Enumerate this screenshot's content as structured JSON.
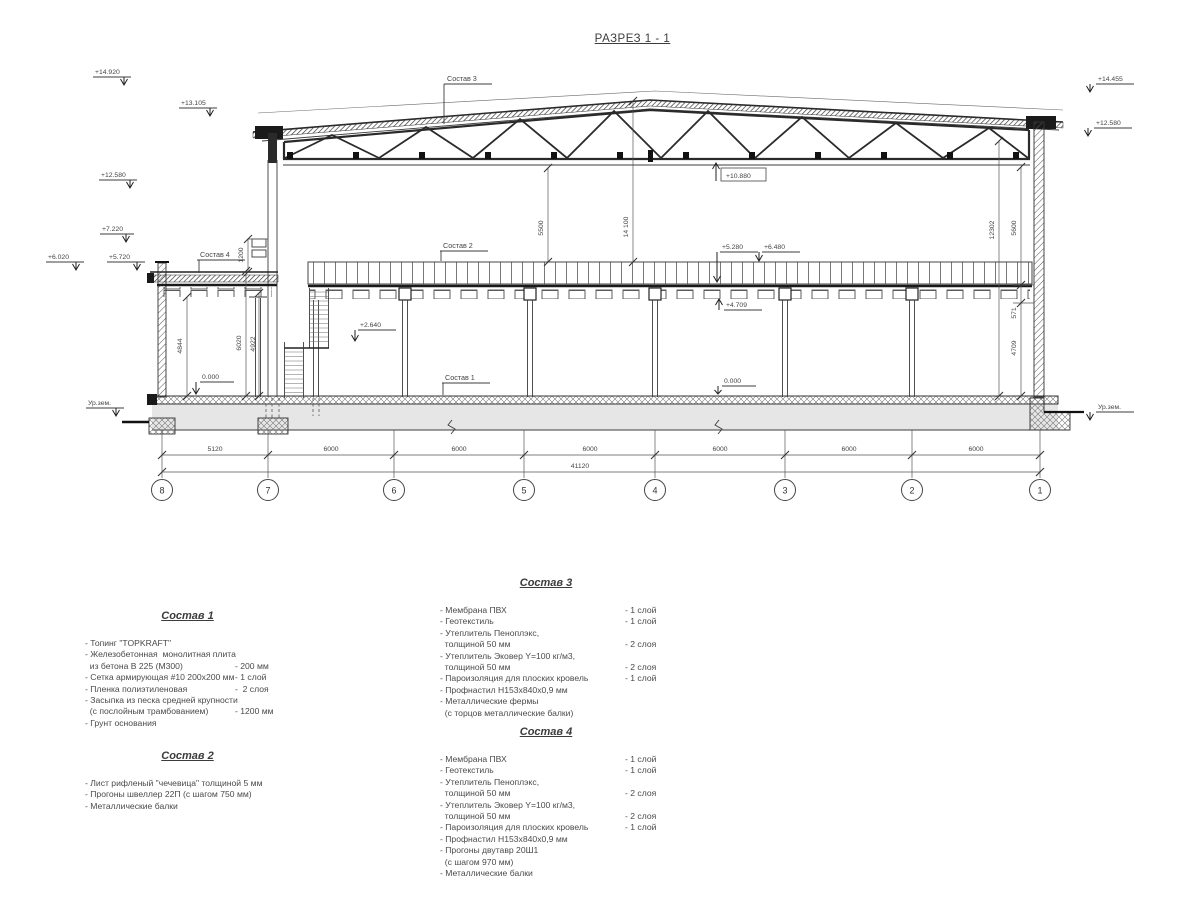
{
  "title": "РАЗРЕЗ 1 - 1",
  "colors": {
    "line": "#3c3c3c",
    "ground_fill": "#e6e6e6",
    "dark": "#1a1a1a"
  },
  "axes": [
    "8",
    "7",
    "6",
    "5",
    "4",
    "3",
    "2",
    "1"
  ],
  "hdims": {
    "spans": [
      "5120",
      "6000",
      "6000",
      "6000",
      "6000",
      "6000",
      "6000"
    ],
    "total": "41120"
  },
  "vdims": {
    "v5500": "5500",
    "v14100": "14 100",
    "v1200": "1200",
    "v4844": "4844",
    "v6020": "6020",
    "v4922": "4922",
    "v12302": "12302",
    "v5600": "5600",
    "v571": "571",
    "v4709": "4709"
  },
  "marks": {
    "e14920": "+14.920",
    "e13105": "+13.105",
    "e12580l": "+12.580",
    "e7220": "+7.220",
    "e6020": "+6.020",
    "e5720": "+5.720",
    "e14455": "+14.455",
    "e12580r": "+12.580",
    "e10880": "+10.880",
    "e5280": "+5.280",
    "e6480": "+6.480",
    "e4709": "+4.709",
    "e2640": "+2.640",
    "zero_left": "0.000",
    "zero_right": "0.000",
    "ground_left": "Ур.зем.",
    "ground_right": "Ур.зем."
  },
  "drawing_labels": {
    "comp1": "Состав 1",
    "comp2": "Состав 2",
    "comp3": "Состав 3",
    "comp4": "Состав 4"
  },
  "blocks": {
    "comp1": {
      "title": "Состав 1",
      "rows": [
        [
          "- Топинг \"TOPKRAFT\"",
          ""
        ],
        [
          "- Железобетонная  монолитная плита",
          ""
        ],
        [
          "  из бетона В 225 (М300)",
          "- 200 мм"
        ],
        [
          "- Сетка армирующая #10 200х200 мм",
          "- 1 слой"
        ],
        [
          "- Пленка полиэтиленовая",
          "-  2 слоя"
        ],
        [
          "- Засыпка из песка средней крупности",
          ""
        ],
        [
          "  (с послойным трамбованием)",
          "- 1200 мм"
        ],
        [
          "- Грунт основания",
          ""
        ]
      ]
    },
    "comp2": {
      "title": "Состав 2",
      "rows": [
        [
          "- Лист рифленый \"чечевица\" толщиной 5 мм",
          ""
        ],
        [
          "- Прогоны швеллер 22П (с шагом 750 мм)",
          ""
        ],
        [
          "- Металлические балки",
          ""
        ]
      ]
    },
    "comp3": {
      "title": "Состав 3",
      "rows": [
        [
          "- Мембрана ПВХ",
          "- 1 слой"
        ],
        [
          "- Геотекстиль",
          "- 1 слой"
        ],
        [
          "- Утеплитель Пеноплэкс,",
          ""
        ],
        [
          "  толщиной 50 мм",
          "- 2 слоя"
        ],
        [
          "- Утеплитель Эковер Y=100 кг/м3,",
          ""
        ],
        [
          "  толщиной 50 мм",
          "- 2 слоя"
        ],
        [
          "- Пароизоляция для плоских кровель",
          "- 1 слой"
        ],
        [
          "- Профнастил Н153х840х0,9 мм",
          ""
        ],
        [
          "- Металлические фермы",
          ""
        ],
        [
          "  (с торцов металлические балки)",
          ""
        ]
      ]
    },
    "comp4": {
      "title": "Состав 4",
      "rows": [
        [
          "- Мембрана ПВХ",
          "- 1 слой"
        ],
        [
          "- Геотекстиль",
          "- 1 слой"
        ],
        [
          "- Утеплитель Пеноплэкс,",
          ""
        ],
        [
          "  толщиной 50 мм",
          "- 2 слоя"
        ],
        [
          "- Утеплитель Эковер Y=100 кг/м3,",
          ""
        ],
        [
          "  толщиной 50 мм",
          "- 2 слоя"
        ],
        [
          "- Пароизоляция для плоских кровель",
          "- 1 слой"
        ],
        [
          "- Профнастил Н153х840х0,9 мм",
          ""
        ],
        [
          "- Прогоны двутавр 20Ш1",
          ""
        ],
        [
          "  (с шагом 970 мм)",
          ""
        ],
        [
          "- Металлические балки",
          ""
        ]
      ]
    }
  }
}
